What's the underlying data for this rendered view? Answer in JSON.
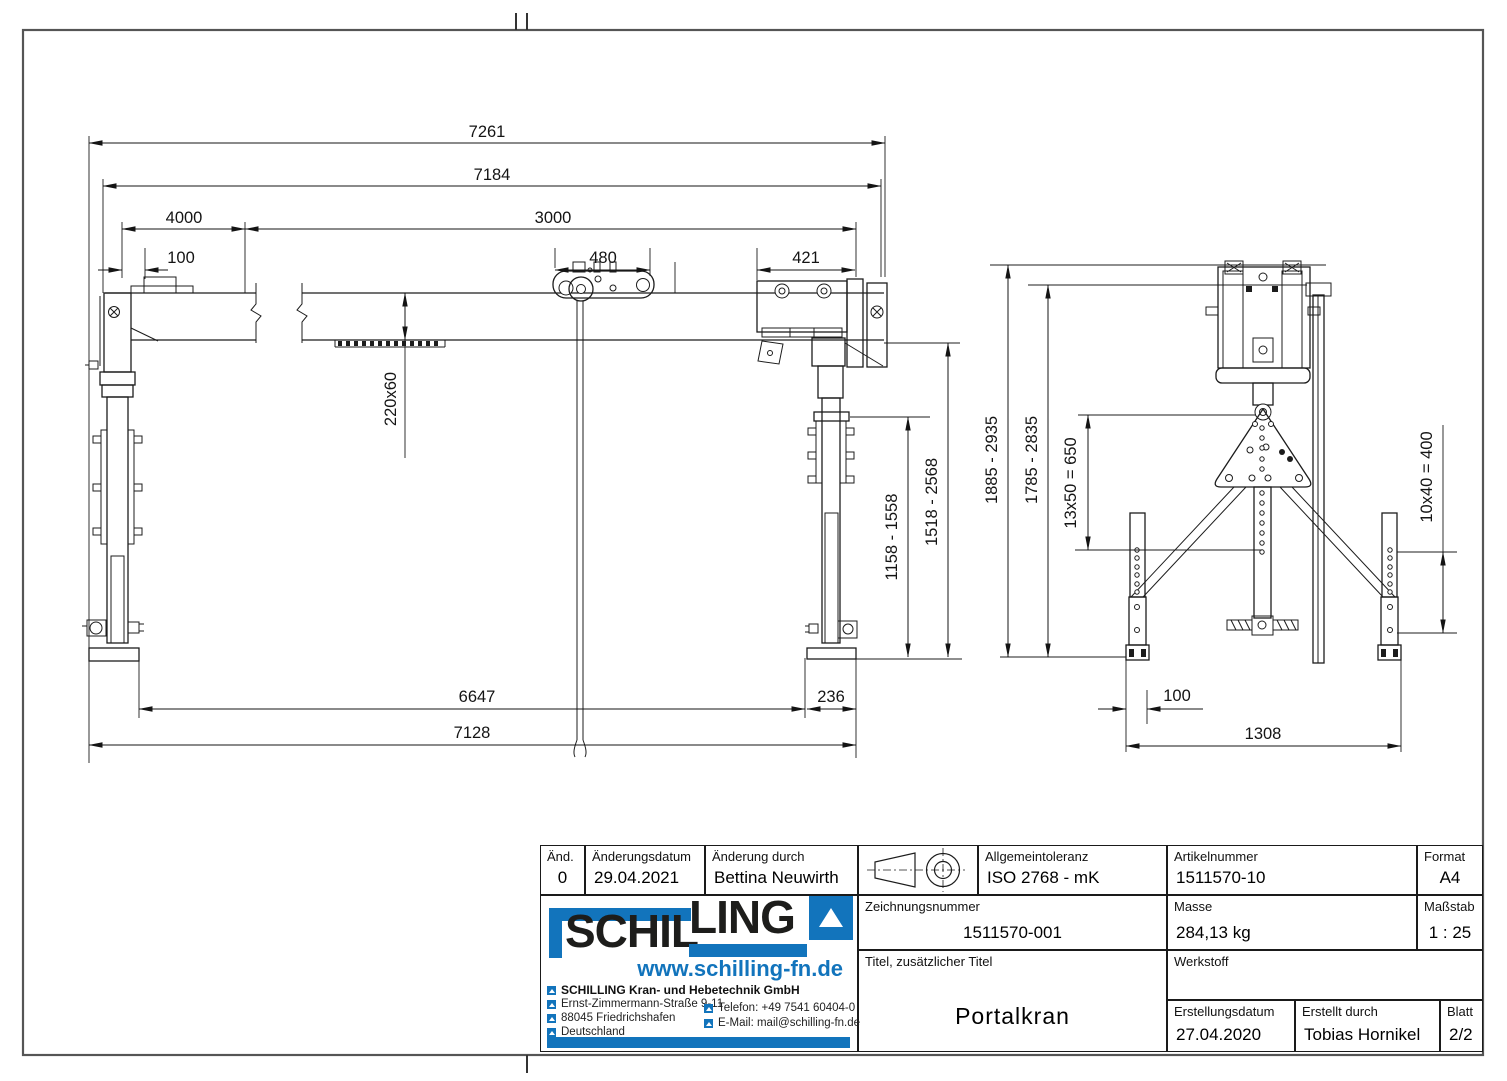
{
  "drawing": {
    "dims": {
      "d7261": "7261",
      "d7184": "7184",
      "d4000": "4000",
      "d3000": "3000",
      "d100_beam": "100",
      "d480": "480",
      "d421": "421",
      "d220x60": "220x60",
      "d1158_1558": "1158 - 1558",
      "d1518_2568": "1518 - 2568",
      "d6647": "6647",
      "d236": "236",
      "d7128": "7128",
      "d1885_2935": "1885 - 2935",
      "d1785_2835": "1785 - 2835",
      "d13x50": "13x50 = 650",
      "d10x40": "10x40 = 400",
      "d100_foot": "100",
      "d1308": "1308"
    }
  },
  "title_block": {
    "aend": {
      "label": "Änd.",
      "value": "0"
    },
    "aenderungsdatum": {
      "label": "Änderungsdatum",
      "value": "29.04.2021"
    },
    "aenderung_durch": {
      "label": "Änderung durch",
      "value": "Bettina Neuwirth"
    },
    "allgemeintoleranz": {
      "label": "Allgemeintoleranz",
      "value": "ISO 2768 - mK"
    },
    "artikelnummer": {
      "label": "Artikelnummer",
      "value": "1511570-10"
    },
    "format": {
      "label": "Format",
      "value": "A4"
    },
    "zeichnungsnummer": {
      "label": "Zeichnungsnummer",
      "value": "1511570-001"
    },
    "masse": {
      "label": "Masse",
      "value": "284,13 kg"
    },
    "massstab": {
      "label": "Maßstab",
      "value": "1 : 25"
    },
    "titel": {
      "label": "Titel, zusätzlicher Titel",
      "value": "Portalkran"
    },
    "werkstoff": {
      "label": "Werkstoff",
      "value": ""
    },
    "erstellungsdatum": {
      "label": "Erstellungsdatum",
      "value": "27.04.2020"
    },
    "erstellt_durch": {
      "label": "Erstellt durch",
      "value": "Tobias Hornikel"
    },
    "blatt": {
      "label": "Blatt",
      "value": "2/2"
    }
  },
  "company": {
    "logo_part1": "SCHIL",
    "logo_part2": "LING",
    "website": "www.schilling-fn.de",
    "name": "SCHILLING Kran- und Hebetechnik GmbH",
    "address_line1": "Ernst-Zimmermann-Straße 9-11",
    "address_line2": "88045 Friedrichshafen",
    "address_line3": "Deutschland",
    "phone": "Telefon: +49 7541 60404-0",
    "email": "E-Mail: mail@schilling-fn.de",
    "brand_blue": "#1274bc"
  }
}
